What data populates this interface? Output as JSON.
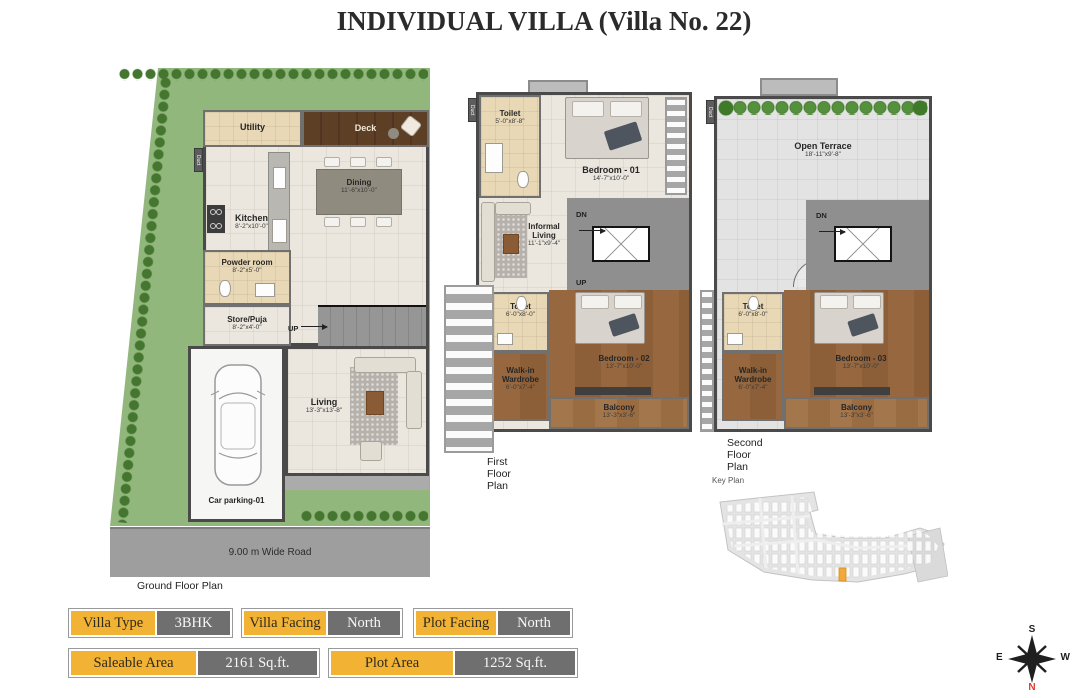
{
  "title": "INDIVIDUAL VILLA (Villa  No. 22)",
  "plans": {
    "ground": {
      "caption": "Ground Floor Plan",
      "road_label": "9.00 m Wide Road",
      "duct": "Duct",
      "up": "UP",
      "utility": {
        "name": "Utility"
      },
      "deck": {
        "name": "Deck"
      },
      "kitchen": {
        "name": "Kitchen",
        "dim": "8'-2\"x10'-0\""
      },
      "dining": {
        "name": "Dining",
        "dim": "11'-6\"x10'-0\""
      },
      "powder_room": {
        "name": "Powder room",
        "dim": "8'-2\"x5'-0\""
      },
      "store_puja": {
        "name": "Store/Puja",
        "dim": "8'-2\"x4'-0\""
      },
      "living": {
        "name": "Living",
        "dim": "13'-3\"x13'-8\""
      },
      "car_parking": {
        "name": "Car parking-01"
      }
    },
    "first": {
      "caption": "First Floor Plan",
      "duct": "Duct",
      "dn": "DN",
      "up": "UP",
      "toilet_top": {
        "name": "Toilet",
        "dim": "5'-0\"x8'-8\""
      },
      "bedroom_01": {
        "name": "Bedroom - 01",
        "dim": "14'-7\"x10'-0\""
      },
      "informal_living": {
        "name": "Informal Living",
        "dim": "11'-1\"x9'-4\""
      },
      "toilet_bottom": {
        "name": "Toilet",
        "dim": "6'-0\"x8'-0\""
      },
      "wardrobe": {
        "name": "Walk-in Wardrobe",
        "dim": "6'-0\"x7'-4\""
      },
      "bedroom_02": {
        "name": "Bedroom - 02",
        "dim": "13'-7\"x10'-0\""
      },
      "balcony": {
        "name": "Balcony",
        "dim": "13'-3\"x3'-6\""
      }
    },
    "second": {
      "caption": "Second Floor Plan",
      "duct": "Duct",
      "dn": "DN",
      "open_terrace": {
        "name": "Open Terrace",
        "dim": "18'-11\"x9'-8\""
      },
      "toilet": {
        "name": "Toilet",
        "dim": "6'-0\"x8'-0\""
      },
      "wardrobe": {
        "name": "Walk-in Wardrobe",
        "dim": "6'-0\"x7'-4\""
      },
      "bedroom_03": {
        "name": "Bedroom - 03",
        "dim": "13'-7\"x10'-0\""
      },
      "balcony": {
        "name": "Balcony",
        "dim": "13'-3\"x3'-6\""
      }
    }
  },
  "key_plan": {
    "caption": "Key Plan"
  },
  "compass": {
    "north": "N",
    "south": "S",
    "east": "E",
    "west": "W"
  },
  "info_badges": [
    {
      "label": "Villa Type",
      "value": "3BHK"
    },
    {
      "label": "Villa Facing",
      "value": "North"
    },
    {
      "label": "Plot Facing",
      "value": "North"
    },
    {
      "label": "Saleable Area",
      "value": "2161 Sq.ft."
    },
    {
      "label": "Plot Area",
      "value": "1252 Sq.ft."
    }
  ],
  "colors": {
    "badge_orange": "#F2B233",
    "badge_gray": "#6F6F6F",
    "highlight_plot": "#F2A93B",
    "compass_north_red": "#E03A2F"
  }
}
